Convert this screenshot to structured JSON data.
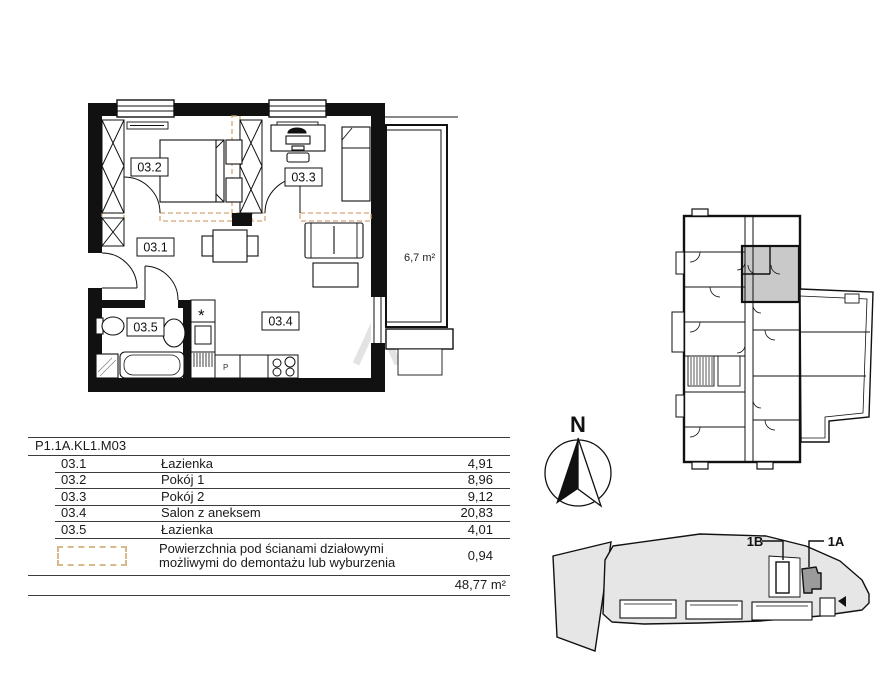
{
  "plan": {
    "room_labels": {
      "r1": "03.1",
      "r2": "03.2",
      "r3": "03.3",
      "r4": "03.4",
      "r5": "03.5"
    },
    "balcony_area": "6,7 m²",
    "washer_symbol": "*",
    "dishwasher_label": "P"
  },
  "compass": {
    "north_label": "N"
  },
  "site_plan": {
    "label_1b": "1B",
    "label_1a": "1A"
  },
  "legend_table": {
    "unit_code": "P1.1A.KL1.M03",
    "rows": [
      {
        "no": "03.1",
        "name": "Łazienka",
        "area": "4,91"
      },
      {
        "no": "03.2",
        "name": "Pokój 1",
        "area": "8,96"
      },
      {
        "no": "03.3",
        "name": "Pokój 2",
        "area": "9,12"
      },
      {
        "no": "03.4",
        "name": "Salon z aneksem",
        "area": "20,83"
      },
      {
        "no": "03.5",
        "name": "Łazienka",
        "area": "4,01"
      }
    ],
    "demolishable_note": "Powierzchnia pod ścianami działowymi możliwymi do demontażu lub wyburzenia",
    "demolishable_area": "0,94",
    "total_area": "48,77 m²"
  },
  "colors": {
    "wall": "#111111",
    "demolishable_dash": "#d2a876",
    "highlighted_unit": "#c9c9c9",
    "site_fill": "#e6e6e6",
    "site_unit_dark": "#9b9b9b"
  }
}
